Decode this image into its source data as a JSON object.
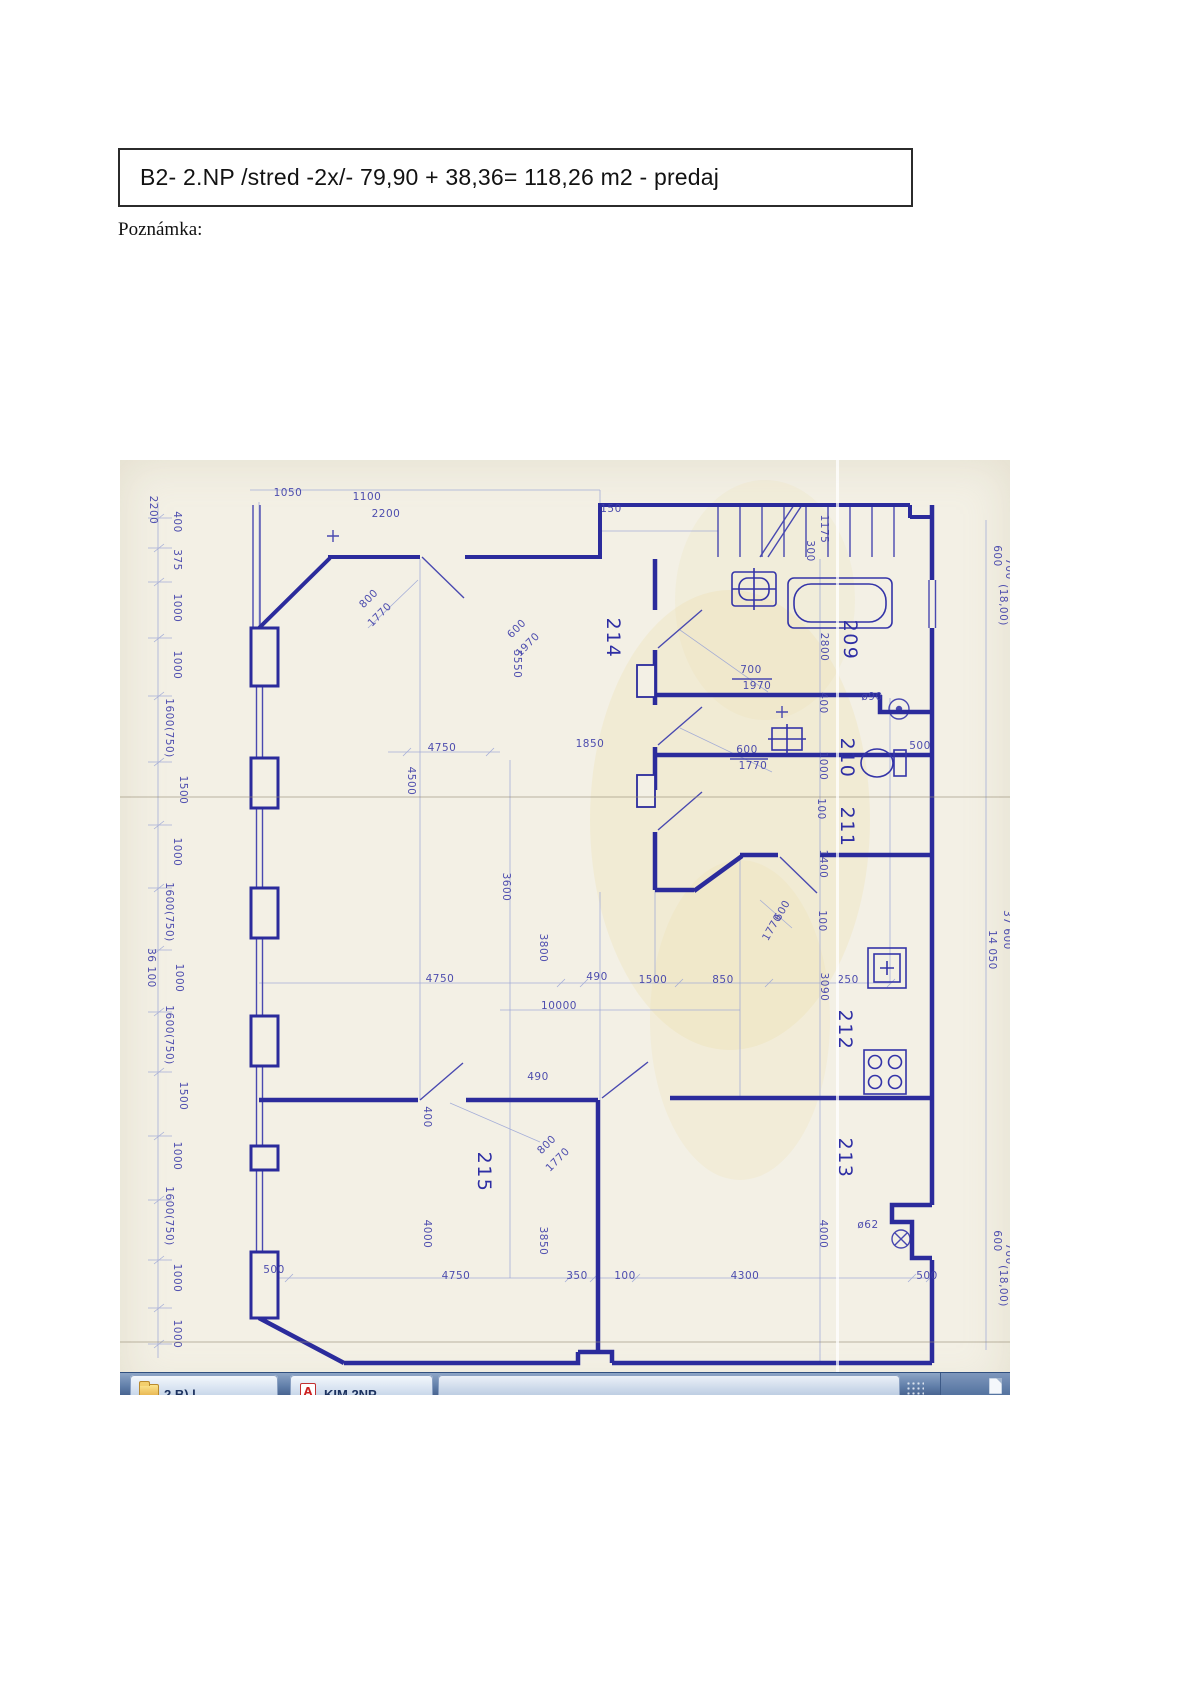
{
  "header": {
    "title": "B2- 2.NP /stred -2x/- 79,90 + 38,36= 118,26 m2 - predaj"
  },
  "note_label": "Poznámka:",
  "colors": {
    "ink": "#2b2b9c",
    "ink_light": "#98a3d6",
    "paper": "#f3f0e5",
    "taskbar_blue": "#5f7da8",
    "label_blue": "#4040aa"
  },
  "blueprint": {
    "description": "scanned hand-drawn floor plan, 2nd floor flat B2",
    "labels": [
      {
        "t": "2200",
        "x": 30,
        "y": 50,
        "r": 90
      },
      {
        "t": "400",
        "x": 54,
        "y": 62,
        "r": 90
      },
      {
        "t": "375",
        "x": 54,
        "y": 100,
        "r": 90
      },
      {
        "t": "1000",
        "x": 54,
        "y": 148,
        "r": 90
      },
      {
        "t": "1000",
        "x": 54,
        "y": 205,
        "r": 90
      },
      {
        "t": "1600(750)",
        "x": 46,
        "y": 268,
        "r": 90
      },
      {
        "t": "1500",
        "x": 60,
        "y": 330,
        "r": 90
      },
      {
        "t": "1000",
        "x": 54,
        "y": 392,
        "r": 90
      },
      {
        "t": "1600(750)",
        "x": 46,
        "y": 452,
        "r": 90
      },
      {
        "t": "36 100",
        "x": 28,
        "y": 508,
        "r": 90
      },
      {
        "t": "1000",
        "x": 56,
        "y": 518,
        "r": 90
      },
      {
        "t": "1600(750)",
        "x": 46,
        "y": 575,
        "r": 90
      },
      {
        "t": "1500",
        "x": 60,
        "y": 636,
        "r": 90
      },
      {
        "t": "1000",
        "x": 54,
        "y": 696,
        "r": 90
      },
      {
        "t": "1600(750)",
        "x": 46,
        "y": 756,
        "r": 90
      },
      {
        "t": "1000",
        "x": 54,
        "y": 818,
        "r": 90
      },
      {
        "t": "1000",
        "x": 54,
        "y": 874,
        "r": 90
      },
      {
        "t": "1050",
        "x": 168,
        "y": 36
      },
      {
        "t": "1100",
        "x": 247,
        "y": 40
      },
      {
        "t": "2200",
        "x": 266,
        "y": 57
      },
      {
        "t": "150",
        "x": 491,
        "y": 52
      },
      {
        "t": "1175",
        "x": 701,
        "y": 69,
        "r": 90
      },
      {
        "t": "300",
        "x": 687,
        "y": 91,
        "r": 90
      },
      {
        "t": "600",
        "x": 874,
        "y": 96,
        "r": 90
      },
      {
        "t": "700",
        "x": 886,
        "y": 109,
        "r": 90
      },
      {
        "t": "(18,00)",
        "x": 880,
        "y": 145,
        "r": 90
      },
      {
        "t": "37 600",
        "x": 884,
        "y": 470,
        "r": 90
      },
      {
        "t": "14 050",
        "x": 869,
        "y": 490,
        "r": 90
      },
      {
        "t": "600",
        "x": 874,
        "y": 781,
        "r": 90
      },
      {
        "t": "700",
        "x": 886,
        "y": 794,
        "r": 90
      },
      {
        "t": "(18,00)",
        "x": 880,
        "y": 826,
        "r": 90
      },
      {
        "t": "209",
        "x": 724,
        "y": 180,
        "r": 90,
        "s": "room"
      },
      {
        "t": "210",
        "x": 721,
        "y": 298,
        "r": 90,
        "s": "room"
      },
      {
        "t": "211",
        "x": 721,
        "y": 367,
        "r": 90,
        "s": "room"
      },
      {
        "t": "214",
        "x": 487,
        "y": 178,
        "r": 90,
        "s": "room"
      },
      {
        "t": "212",
        "x": 719,
        "y": 570,
        "r": 90,
        "s": "room"
      },
      {
        "t": "213",
        "x": 719,
        "y": 698,
        "r": 90,
        "s": "room"
      },
      {
        "t": "215",
        "x": 358,
        "y": 712,
        "r": 90,
        "s": "room"
      },
      {
        "t": "2800",
        "x": 701,
        "y": 187,
        "r": 90
      },
      {
        "t": "700",
        "x": 631,
        "y": 213
      },
      {
        "t": "1970",
        "x": 637,
        "y": 229
      },
      {
        "t": "400",
        "x": 700,
        "y": 243,
        "r": 90
      },
      {
        "t": "ø90",
        "x": 752,
        "y": 240
      },
      {
        "t": "500",
        "x": 800,
        "y": 289
      },
      {
        "t": "600",
        "x": 627,
        "y": 293
      },
      {
        "t": "1770",
        "x": 633,
        "y": 309
      },
      {
        "t": "1000",
        "x": 700,
        "y": 306,
        "r": 90
      },
      {
        "t": "100",
        "x": 698,
        "y": 349,
        "r": 90
      },
      {
        "t": "1400",
        "x": 700,
        "y": 404,
        "r": 90
      },
      {
        "t": "800",
        "x": 251,
        "y": 141,
        "r": -45
      },
      {
        "t": "1770",
        "x": 262,
        "y": 157,
        "r": -45
      },
      {
        "t": "600",
        "x": 399,
        "y": 171,
        "r": -45
      },
      {
        "t": "1970",
        "x": 410,
        "y": 187,
        "r": -45
      },
      {
        "t": "5550",
        "x": 394,
        "y": 204,
        "r": 90
      },
      {
        "t": "1850",
        "x": 470,
        "y": 287
      },
      {
        "t": "4750",
        "x": 322,
        "y": 291
      },
      {
        "t": "4500",
        "x": 288,
        "y": 321,
        "r": 90
      },
      {
        "t": "3600",
        "x": 383,
        "y": 427,
        "r": 90
      },
      {
        "t": "4750",
        "x": 320,
        "y": 522
      },
      {
        "t": "490",
        "x": 477,
        "y": 520
      },
      {
        "t": "1500",
        "x": 533,
        "y": 523
      },
      {
        "t": "850",
        "x": 603,
        "y": 523
      },
      {
        "t": "250",
        "x": 728,
        "y": 523
      },
      {
        "t": "3090",
        "x": 701,
        "y": 527,
        "r": 90
      },
      {
        "t": "3800",
        "x": 420,
        "y": 488,
        "r": 90
      },
      {
        "t": "10000",
        "x": 439,
        "y": 549
      },
      {
        "t": "600",
        "x": 665,
        "y": 452,
        "r": -60
      },
      {
        "t": "1770",
        "x": 655,
        "y": 469,
        "r": -60
      },
      {
        "t": "100",
        "x": 699,
        "y": 461,
        "r": 90
      },
      {
        "t": "490",
        "x": 418,
        "y": 620
      },
      {
        "t": "400",
        "x": 304,
        "y": 657,
        "r": 90
      },
      {
        "t": "800",
        "x": 429,
        "y": 687,
        "r": -45
      },
      {
        "t": "1770",
        "x": 440,
        "y": 702,
        "r": -45
      },
      {
        "t": "4000",
        "x": 304,
        "y": 774,
        "r": 90
      },
      {
        "t": "3850",
        "x": 420,
        "y": 781,
        "r": 90
      },
      {
        "t": "4000",
        "x": 700,
        "y": 774,
        "r": 90
      },
      {
        "t": "ø62",
        "x": 748,
        "y": 768
      },
      {
        "t": "500",
        "x": 154,
        "y": 813
      },
      {
        "t": "4750",
        "x": 336,
        "y": 819
      },
      {
        "t": "350",
        "x": 457,
        "y": 819
      },
      {
        "t": "100",
        "x": 505,
        "y": 819
      },
      {
        "t": "4300",
        "x": 625,
        "y": 819
      },
      {
        "t": "500",
        "x": 807,
        "y": 819
      }
    ]
  },
  "taskbar": {
    "buttons": [
      {
        "icon": "folder-icon",
        "label": "2 B) l"
      },
      {
        "icon": "acrobat-icon",
        "label": "KIM 2NP"
      }
    ]
  }
}
